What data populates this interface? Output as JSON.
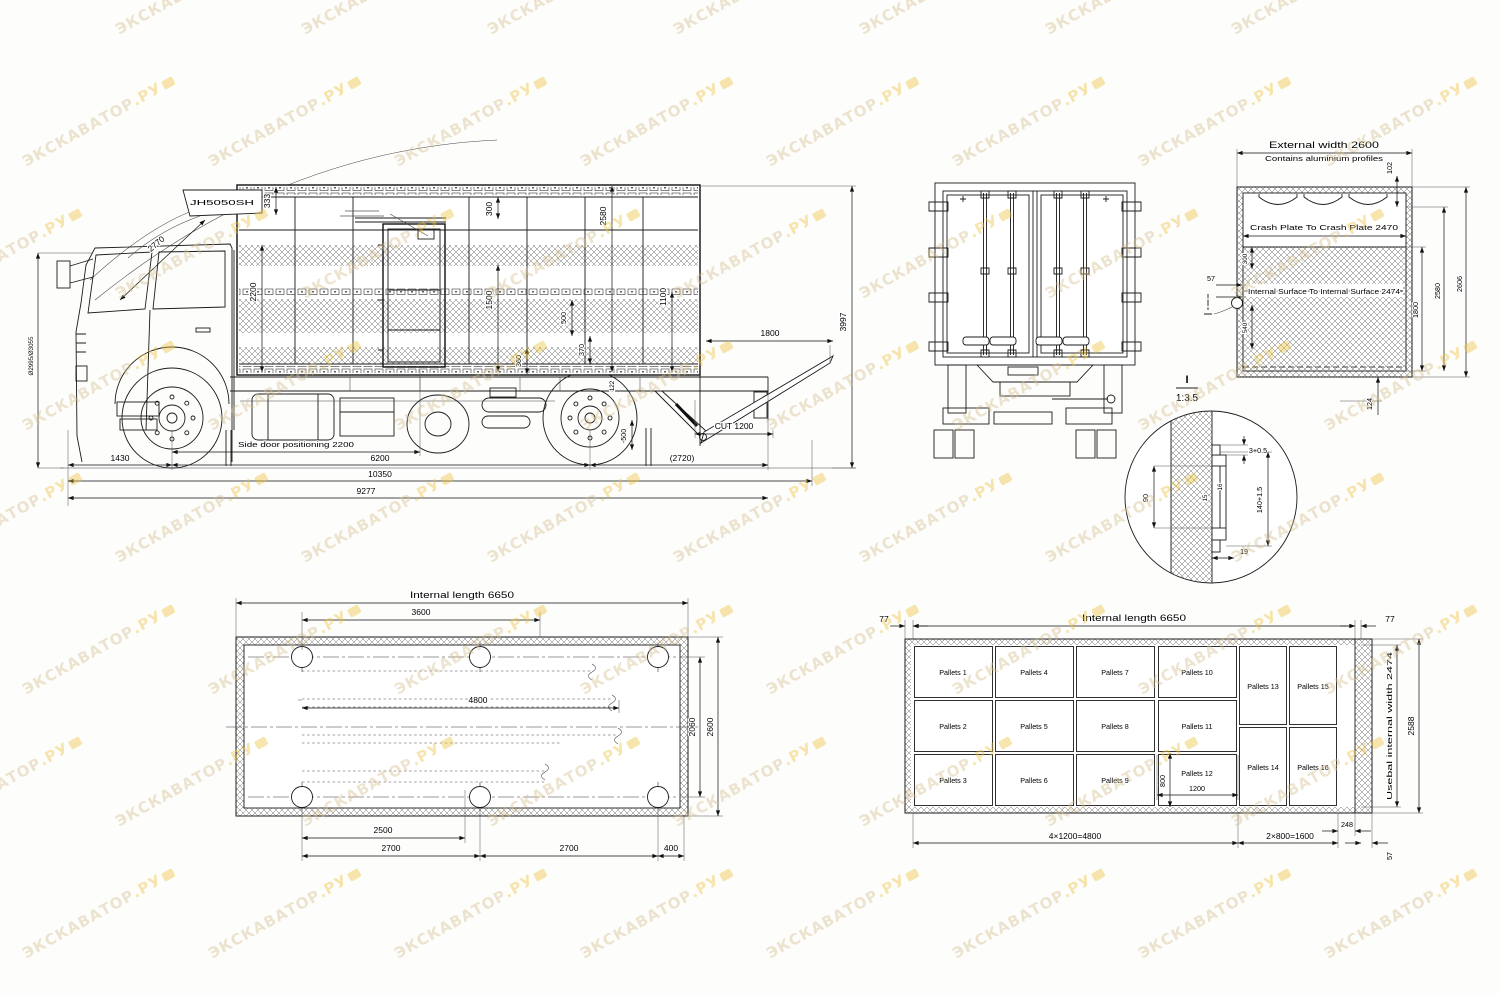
{
  "watermark": {
    "text": "ЭКСКАВАТОР",
    "suffix": ".РУ",
    "color": "#d6c090",
    "accent": "#edc23f"
  },
  "side_view": {
    "model_label": "JH5050SH",
    "cab_arc_dim": "2770",
    "cab_height_dim": "Ø2995/Ø3055",
    "dims": {
      "d333": "333",
      "d2200": "2200",
      "d300": "300",
      "d1500": "1500",
      "d2580": "2580",
      "d1100": "1100",
      "d500": "500",
      "d370": "370",
      "d360": "360",
      "d122": "122",
      "d1800": "1800",
      "d3997": "3997",
      "side_door": "Side door positioning 2200",
      "d1430": "1430",
      "d6200": "6200",
      "d2720": "(2720)",
      "dcut": "CUT 1200",
      "d10350": "10350",
      "d9277": "9277",
      "dm500": "-500"
    }
  },
  "cross_section": {
    "external_width": "External width 2600",
    "profiles_note": "Contains aluminium profiles",
    "crash_plate": "Crash Plate To Crash Plate  2470",
    "internal_surface": "Internal Surface To Internal Surface 2474",
    "d102": "102",
    "d300": "300",
    "d540": "540",
    "d57": "57",
    "d1800": "1800",
    "d2580": "2580",
    "d2606": "2606",
    "d124": "124",
    "detail_mark": "I"
  },
  "detail_view": {
    "mark": "I",
    "scale": "1:3.5",
    "d90": "90",
    "d3": "3+0.5",
    "d140": "140+1.5",
    "d15": "15",
    "d16": "16",
    "d19": "19"
  },
  "plan_view": {
    "title": "Internal length 6650",
    "d3600": "3600",
    "d4800": "4800",
    "d2060": "2060",
    "d2600": "2600",
    "d2500": "2500",
    "d2700a": "2700",
    "d2700b": "2700",
    "d400": "400"
  },
  "pallet_view": {
    "title": "Internal length 6650",
    "d77_left": "77",
    "d77_right": "77",
    "pallets": [
      "Pallets 1",
      "Pallets 2",
      "Pallets 3",
      "Pallets 4",
      "Pallets 5",
      "Pallets 6",
      "Pallets 7",
      "Pallets 8",
      "Pallets 9",
      "Pallets 10",
      "Pallets 11",
      "Pallets 12",
      "Pallets 13",
      "Pallets 14",
      "Pallets 15",
      "Pallets 16"
    ],
    "d800": "800",
    "d1200": "1200",
    "f4800": "4×1200=4800",
    "f1600": "2×800=1600",
    "d248": "248",
    "d57": "57",
    "width_label": "Usebal internal width 2474",
    "d2588": "2588"
  }
}
